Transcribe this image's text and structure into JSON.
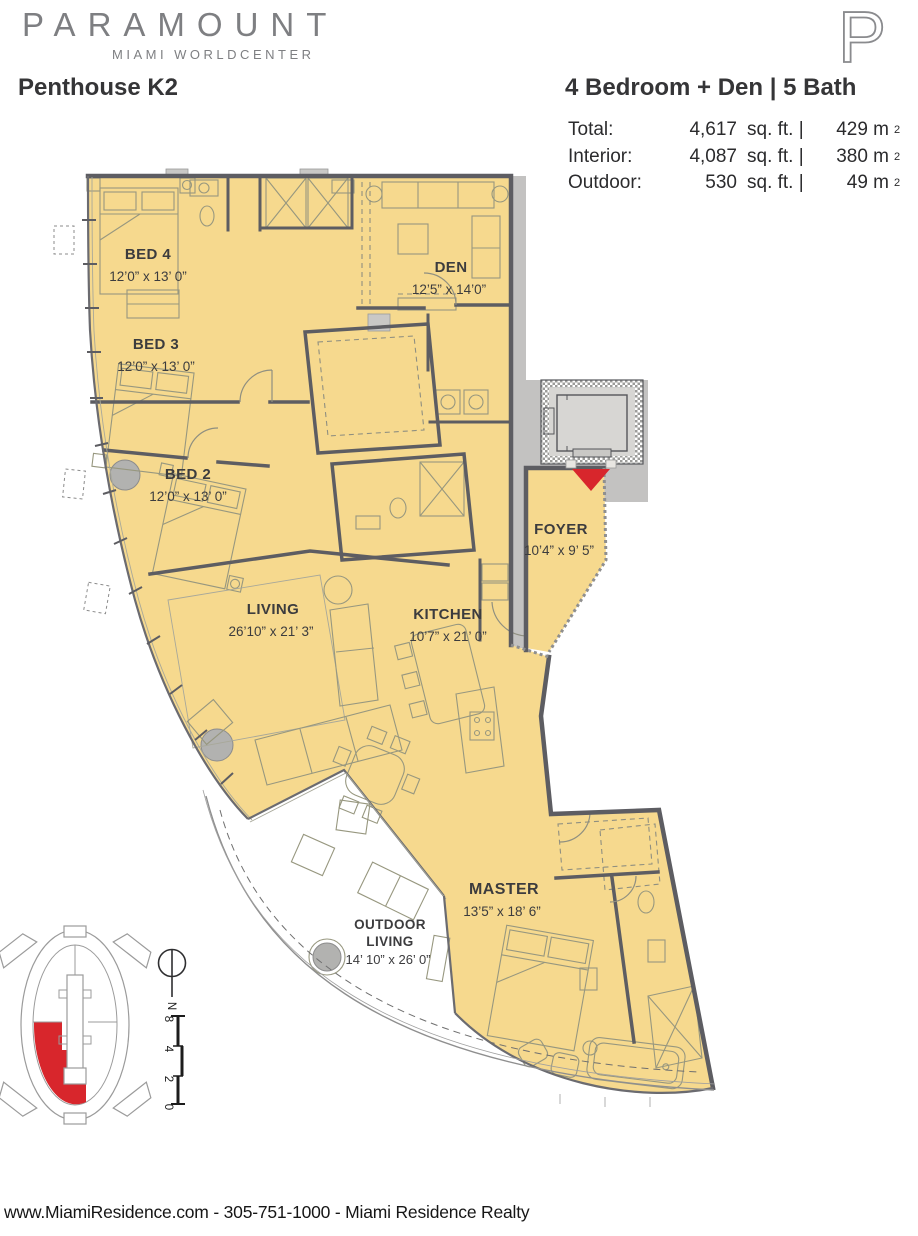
{
  "header": {
    "brand": "PARAMOUNT",
    "brand_sub": "MIAMI WORLDCENTER",
    "logo_letter": "P",
    "plan_name": "Penthouse K2",
    "plan_type": "4 Bedroom + Den | 5 Bath"
  },
  "stats": {
    "rows": [
      {
        "label": "Total:",
        "sqft": "4,617",
        "unit": "sq. ft. |",
        "metric": "429 m",
        "sup": "2"
      },
      {
        "label": "Interior:",
        "sqft": "4,087",
        "unit": "sq. ft. |",
        "metric": "380 m",
        "sup": "2"
      },
      {
        "label": "Outdoor:",
        "sqft": "530",
        "unit": "sq. ft. |",
        "metric": "49 m",
        "sup": "2"
      }
    ]
  },
  "rooms": {
    "bed4": {
      "name": "BED 4",
      "dims": "12’0” x 13’ 0”"
    },
    "bed3": {
      "name": "BED 3",
      "dims": "12’0” x 13’ 0”"
    },
    "bed2": {
      "name": "BED 2",
      "dims": "12’0” x 13’ 0”"
    },
    "den": {
      "name": "DEN",
      "dims": "12’5” x 14’0”"
    },
    "foyer": {
      "name": "FOYER",
      "dims": "10’4” x 9’ 5”"
    },
    "living": {
      "name": "LIVING",
      "dims": "26’10” x 21’ 3”"
    },
    "kitchen": {
      "name": "KITCHEN",
      "dims": "10’7” x 21’ 0”"
    },
    "master": {
      "name": "MASTER",
      "dims": "13’5” x 18’ 6”"
    },
    "outdoor": {
      "name_line1": "OUTDOOR",
      "name_line2": "LIVING",
      "dims": "14’ 10” x 26’ 0”"
    }
  },
  "compass": {
    "label": "N"
  },
  "scale_bar": {
    "labels": [
      "0",
      "2",
      "4",
      "8"
    ]
  },
  "footer": {
    "text": "www.MiamiResidence.com  -  305-751-1000  -  Miami Residence Realty"
  },
  "colors": {
    "unit_fill": "#F6D98E",
    "wall": "#5D5D62",
    "corridor_gray": "#C3C2C1",
    "accent_red": "#D8262C",
    "brand_gray": "#7E7F82",
    "text": "#3C3C3E"
  }
}
